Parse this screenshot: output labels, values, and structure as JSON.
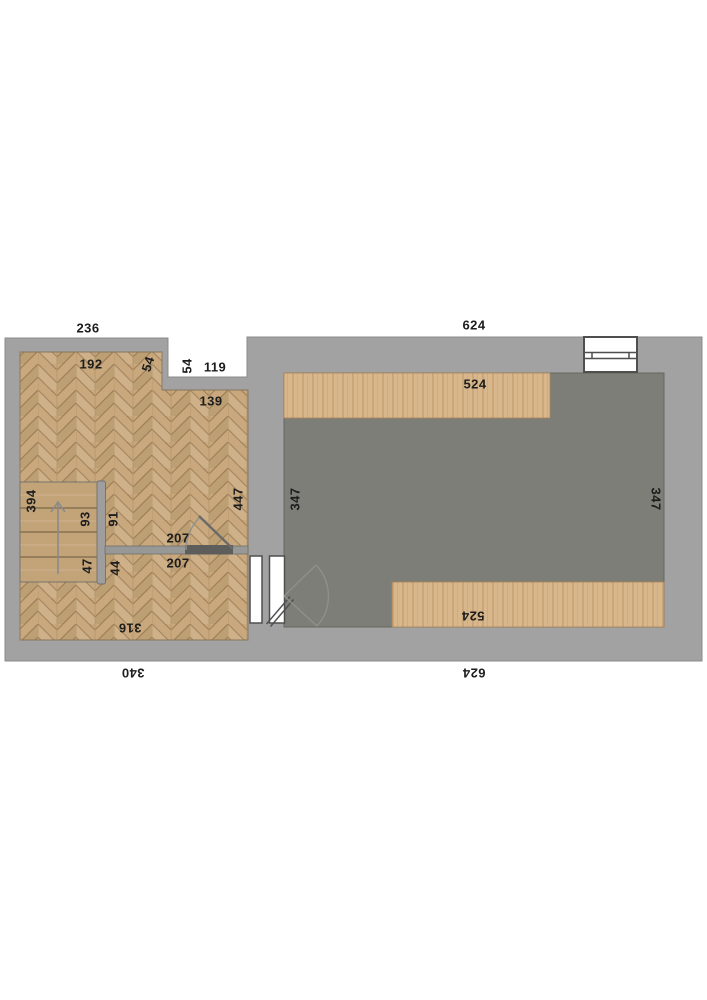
{
  "document": {
    "type": "floor-plan",
    "units_hint": "dimension numbers as shown"
  },
  "colors": {
    "background": "#ffffff",
    "wall_gray": "#a2a2a3",
    "floor_dark_gray": "#7c7e77",
    "parquet_wood": "#c8a87c",
    "stairs_wood": "#c3a378",
    "bench_wood": "#d9b78c",
    "symbol_outline": "#4f4f4f",
    "label_text": "#1d1d1d"
  },
  "icons": {
    "stairs_direction_arrow": "up-arrow"
  },
  "labels": [
    {
      "name": "width-top-left-section",
      "text": "236"
    },
    {
      "name": "width-top-right-section",
      "text": "624"
    },
    {
      "name": "notch-depth",
      "text": "54"
    },
    {
      "name": "notch-width",
      "text": "119"
    },
    {
      "name": "room-top-width",
      "text": "192"
    },
    {
      "name": "wall-step-length",
      "text": "54"
    },
    {
      "name": "alcove-width",
      "text": "139"
    },
    {
      "name": "stairs-length",
      "text": "394"
    },
    {
      "name": "stairs-upper-width",
      "text": "93"
    },
    {
      "name": "stairs-lower-width",
      "text": "47"
    },
    {
      "name": "landing-upper-width",
      "text": "91"
    },
    {
      "name": "landing-lower-width",
      "text": "44"
    },
    {
      "name": "left-room-depth",
      "text": "447"
    },
    {
      "name": "door-clearance-upper",
      "text": "207"
    },
    {
      "name": "door-clearance-lower",
      "text": "207"
    },
    {
      "name": "left-room-bottom-width",
      "text": "316"
    },
    {
      "name": "left-section-outer-width",
      "text": "340"
    },
    {
      "name": "bench-top-length",
      "text": "524"
    },
    {
      "name": "gray-room-depth-left",
      "text": "347"
    },
    {
      "name": "gray-room-depth-right",
      "text": "347"
    },
    {
      "name": "bench-bottom-length",
      "text": "524"
    },
    {
      "name": "width-bottom-right-section",
      "text": "624"
    }
  ]
}
